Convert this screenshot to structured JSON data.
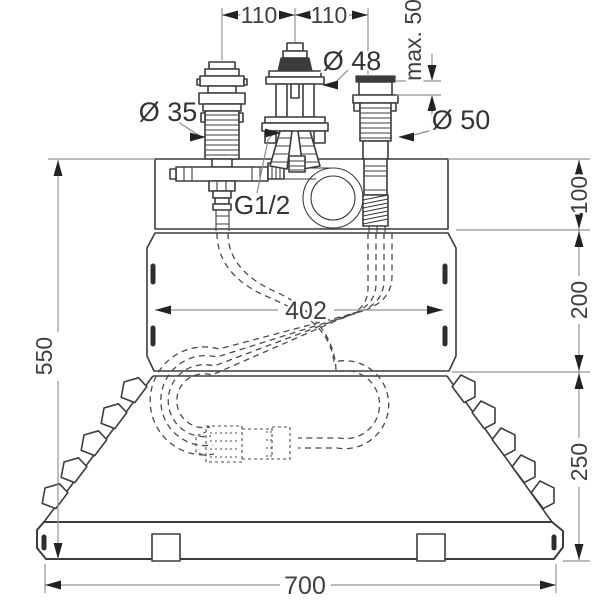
{
  "drawing": {
    "kind": "bath-mixer-installation-dimension-drawing",
    "colors": {
      "background": "#ffffff",
      "outline": "#3c3c3c",
      "dimension_line": "#949494",
      "arrow": "#222222",
      "text": "#3f3f3f"
    },
    "dimensions": {
      "spacing_left": "110",
      "spacing_right": "110",
      "max_thickness": "max. 50",
      "diameter_center": "Ø 48",
      "diameter_left": "Ø 35",
      "diameter_right": "Ø 50",
      "thread_size": "G1/2",
      "slot_spacing": "402",
      "overall_height": "550",
      "deck_height": "100",
      "panel_height": "200",
      "apron_height": "250",
      "overall_width": "700"
    }
  }
}
